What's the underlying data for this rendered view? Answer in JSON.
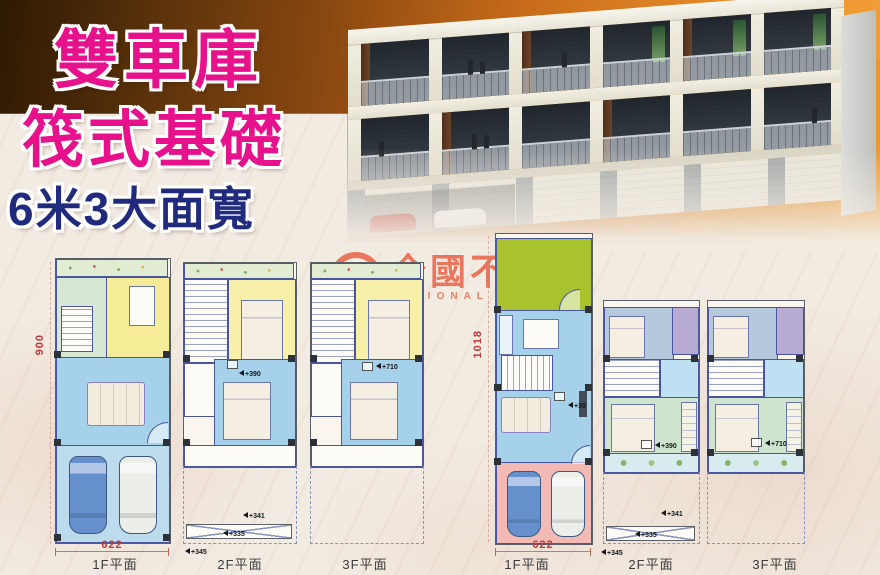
{
  "title": {
    "line1": "雙車庫",
    "line2": "筏式基礎",
    "line3": "6米3大面寬"
  },
  "watermark": {
    "logo_letter": "R",
    "name_zh": "全國不動產",
    "name_en": "NATIONAL REALTY"
  },
  "colors": {
    "title_pink": "#e8118c",
    "title_navy": "#202b7e",
    "band_brown": "#5c330b",
    "band_orange": "#da7d1e",
    "plan_blue": "#a5d1ea",
    "plan_yellow": "#f6eb97",
    "plan_green": "#d8e7d5",
    "plan_lime": "#a9c32f",
    "plan_pink": "#f3bab5",
    "plan_purple": "#b7abd4",
    "dim_red": "#c03a3a"
  },
  "plans": {
    "left_1f": {
      "label": "1F平面",
      "dim_width": "622",
      "dim_height": "900"
    },
    "left_2f": {
      "label": "2F平面",
      "markers": {
        "m390": "+390",
        "m341": "+341",
        "m335": "+335",
        "m345": "+345"
      }
    },
    "left_3f": {
      "label": "3F平面",
      "markers": {
        "m710": "+710"
      }
    },
    "right_1f": {
      "label": "1F平面",
      "dim_width": "622",
      "dim_height": "1018",
      "markers": {
        "m30": "+30"
      }
    },
    "right_2f": {
      "label": "2F平面",
      "markers": {
        "m390": "+390",
        "m341": "+341",
        "m335": "+335",
        "m345": "+345"
      }
    },
    "right_3f": {
      "label": "3F平面",
      "markers": {
        "m710": "+710"
      }
    }
  }
}
